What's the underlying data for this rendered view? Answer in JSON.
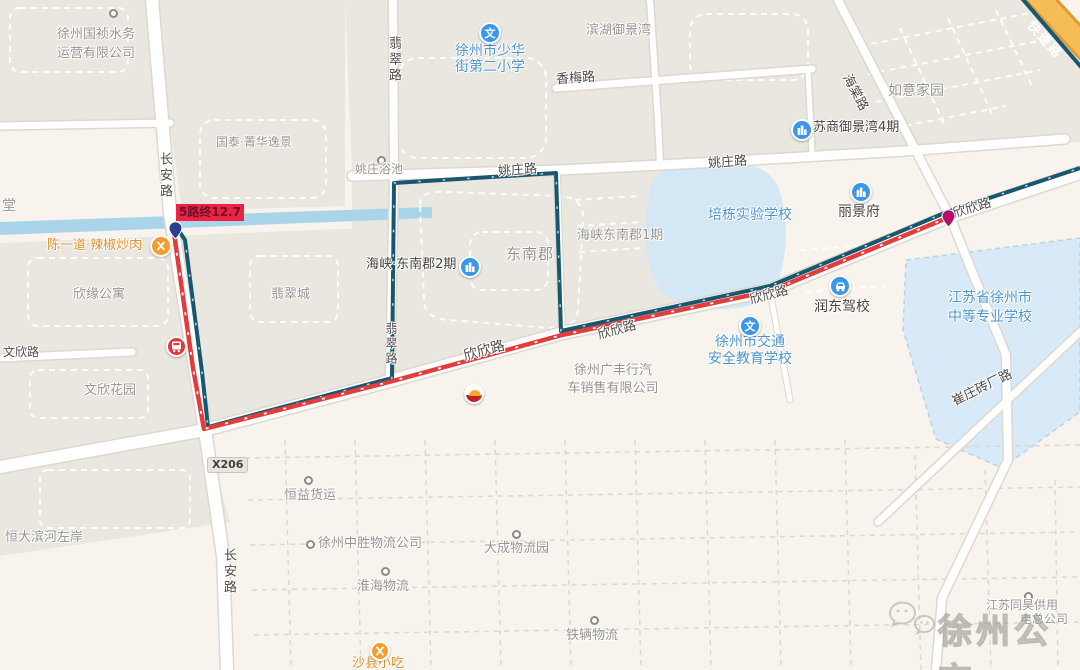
{
  "map": {
    "watermark": {
      "brand": "徐州公交"
    },
    "bus_stop": {
      "label": "5路终12.7"
    },
    "road_badge": {
      "code": "X206"
    },
    "roads": {
      "changan": "长安路",
      "feicui": "翡翠路",
      "yaozhuang": "姚庄路",
      "xiangmei": "香梅路",
      "haitang": "海棠路",
      "xinxin": "欣欣路",
      "wenxin": "文欣路",
      "cuizhuang": "崔庄砖厂路",
      "expressway": "快速路"
    },
    "icons": {
      "school": "文"
    },
    "pois": {
      "guozhen_water": {
        "line1": "徐州国祯水务",
        "line2": "运营有限公司"
      },
      "guotai": {
        "name": "国泰·菁华逸景"
      },
      "shaohua_school": {
        "line1": "徐州市少华",
        "line2": "街第二小学"
      },
      "binhu": {
        "name": "滨湖御景湾"
      },
      "ruyi": {
        "name": "如意家园"
      },
      "sushang": {
        "name": "苏商御景湾4期"
      },
      "lijingfu": {
        "name": "丽景府"
      },
      "peidong_school": {
        "name": "培栋实验学校"
      },
      "yaozhuang_bath": {
        "name": "姚庄浴池"
      },
      "haixia_phase1": {
        "name": "海峡东南郡1期"
      },
      "dongnanjun": {
        "name": "东南郡"
      },
      "haixia_phase2": {
        "name": "海峡·东南郡2期"
      },
      "feicuicheng": {
        "name": "翡翠城"
      },
      "xinyuan": {
        "name": "欣缘公寓"
      },
      "wenxin_garden": {
        "name": "文欣花园"
      },
      "chenyidao": {
        "name": "陈一道·辣椒炒肉"
      },
      "rundong": {
        "name": "润东驾校"
      },
      "jiaotong_school": {
        "line1": "徐州市交通",
        "line2": "安全教育学校"
      },
      "guangfeng": {
        "line1": "徐州广丰行汽",
        "line2": "车销售有限公司"
      },
      "zhongdeng_school": {
        "line1": "江苏省徐州市",
        "line2": "中等专业学校"
      },
      "hengyi": {
        "name": "恒益货运"
      },
      "hengda": {
        "name": "恒大滨河左岸"
      },
      "zhongsheng": {
        "name": "徐州中胜物流公司"
      },
      "dacheng": {
        "name": "大成物流园"
      },
      "huaihai": {
        "name": "淮海物流"
      },
      "tieliang": {
        "name": "铁辆物流"
      },
      "shaxian": {
        "name": "沙县小吃"
      },
      "tang": {
        "name": "堂"
      },
      "tonghao": {
        "line1": "江苏同昊供用",
        "line2": "电总公司"
      }
    },
    "colors": {
      "route_red": "#e23c3c",
      "route_teal": "#17576f",
      "expressway_orange": "#f6bc55",
      "water_blue": "#a9d4e9",
      "campus_blue": "#d8eaf7",
      "poi_blue": "#3b97ea",
      "poi_orange": "#f49d2c",
      "bus_stop_red": "#ee2245",
      "start_marker_blue": "#27418f",
      "end_marker_magenta": "#b8106a"
    }
  }
}
